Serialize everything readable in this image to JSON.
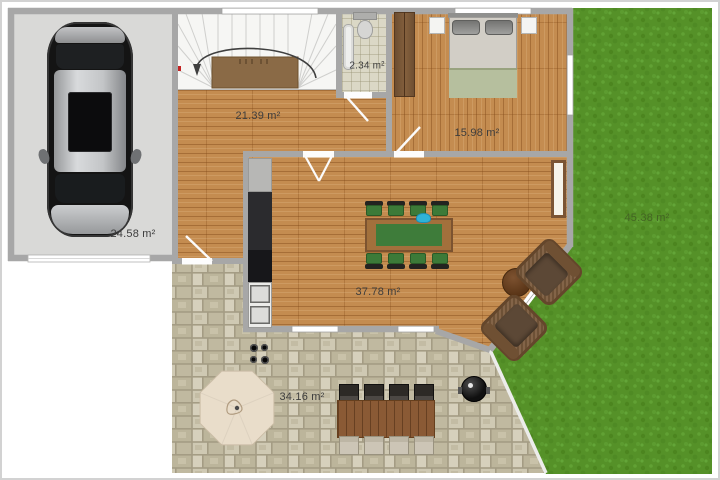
{
  "floorplan": {
    "type": "residential-floor-plan",
    "unit": "m²",
    "rooms": [
      {
        "id": "garage",
        "label": "24.58 m²"
      },
      {
        "id": "hallway",
        "label": "21.39 m²"
      },
      {
        "id": "bathroom",
        "label": "2.34 m²"
      },
      {
        "id": "bedroom",
        "label": "15.98 m²"
      },
      {
        "id": "living-room",
        "label": "37.78 m²"
      },
      {
        "id": "patio",
        "label": "34.16 m²"
      },
      {
        "id": "garden",
        "label": "45.38 m²"
      }
    ],
    "colors": {
      "wood_floor": "#c48c50",
      "grass": "#559128",
      "stone_patio": "#c6bfa8",
      "wall": "#a7a7a7",
      "garage_floor": "#d9d9d7",
      "label_text": "#3d3d3d"
    }
  }
}
